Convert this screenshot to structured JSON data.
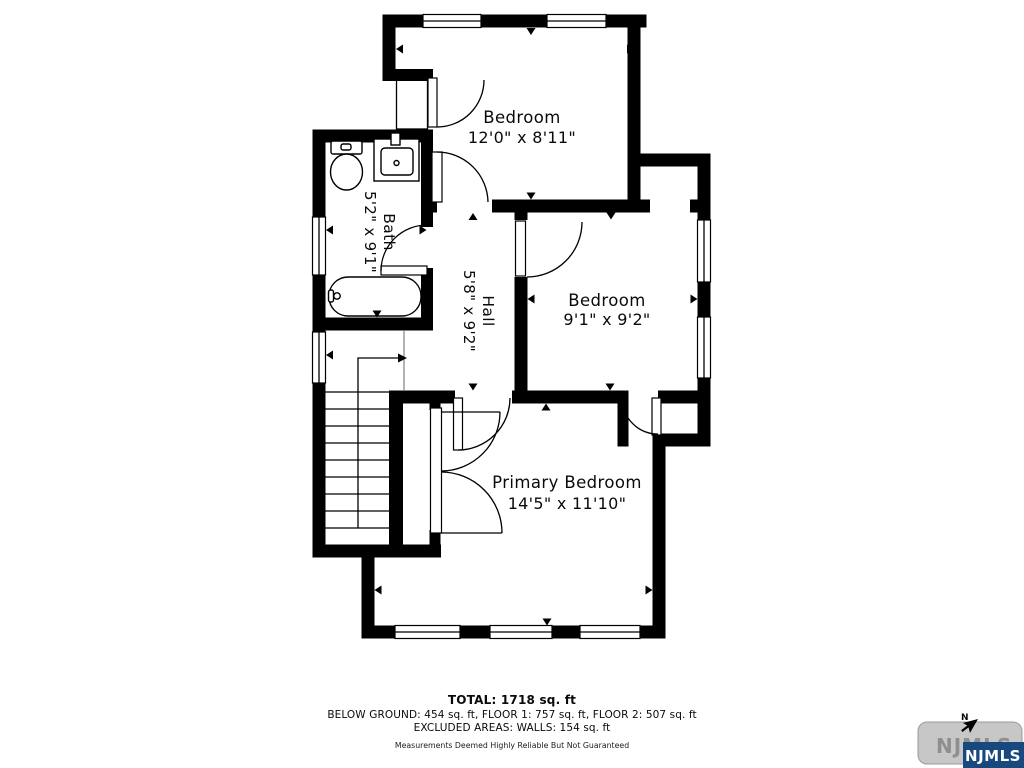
{
  "floor_plan": {
    "rooms": [
      {
        "name": "Bedroom",
        "dims": "12'0\" x 8'11\""
      },
      {
        "name": "Bedroom",
        "dims": "9'1\" x 9'2\""
      },
      {
        "name": "Bath",
        "dims": "5'2\" x 9'1\""
      },
      {
        "name": "Hall",
        "dims": "5'8\" x 9'2\""
      },
      {
        "name": "Primary Bedroom",
        "dims": "14'5\" x 11'10\""
      }
    ]
  },
  "footer": {
    "total": "TOTAL: 1718 sq. ft",
    "breakdown": "BELOW GROUND: 454 sq. ft, FLOOR 1: 757 sq. ft, FLOOR 2: 507 sq. ft",
    "excluded": "EXCLUDED AREAS: WALLS: 154 sq. ft",
    "disclaimer": "Measurements Deemed Highly Reliable But Not Guaranteed"
  },
  "logo": {
    "button_text": "NJMLS",
    "badge_text": "NJMLS",
    "compass_label": "N",
    "badge_color": "#17497e",
    "button_color": "#c7c7c7"
  }
}
